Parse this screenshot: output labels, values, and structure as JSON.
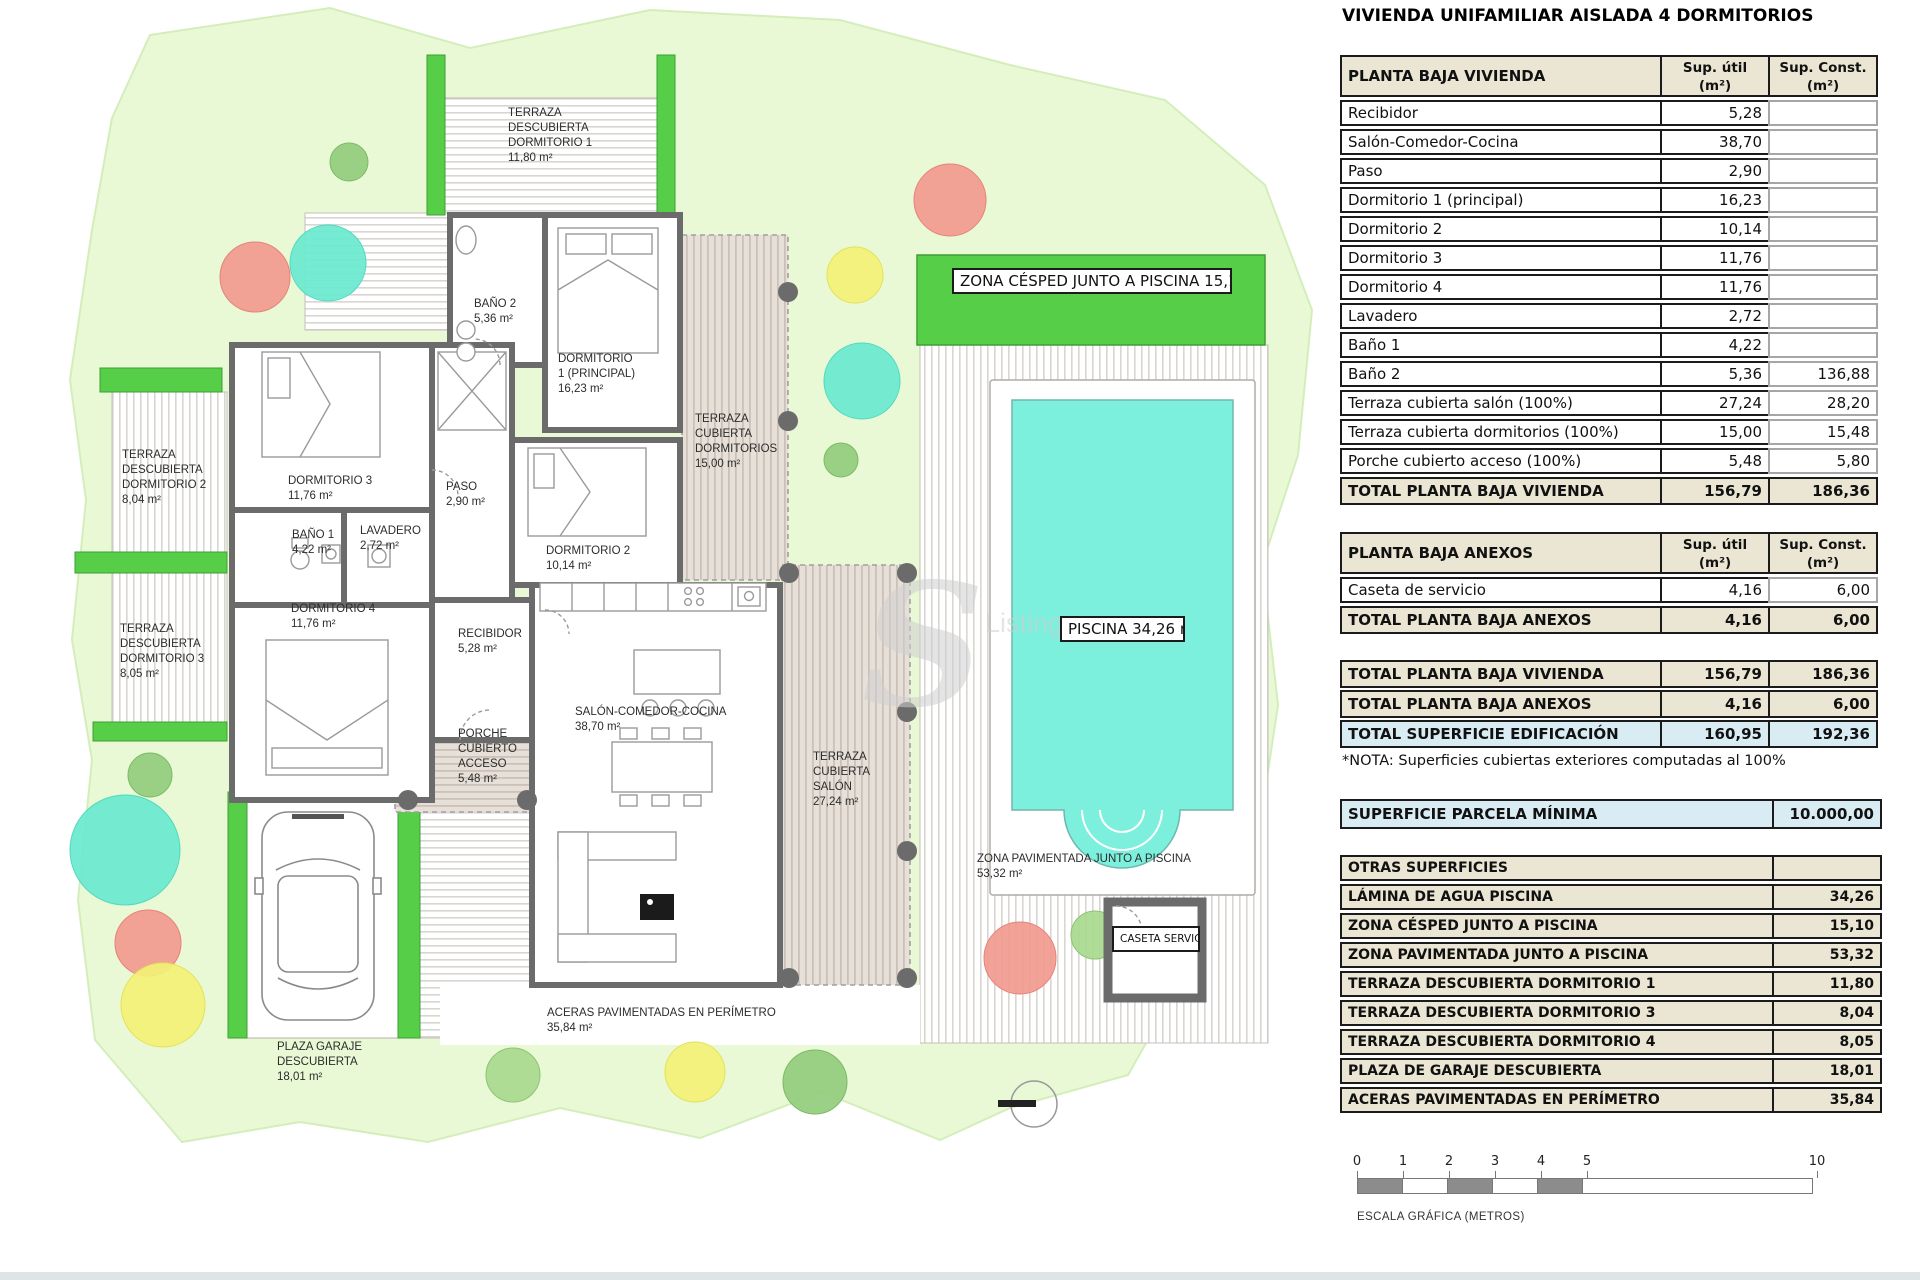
{
  "title": "VIVIENDA UNIFAMILIAR AISLADA 4 DORMITORIOS",
  "tables": {
    "vivienda": {
      "header": "PLANTA BAJA VIVIENDA",
      "col_util": "Sup. útil\n(m²)",
      "col_const": "Sup. Const.\n(m²)",
      "rows": [
        {
          "label": "Recibidor",
          "util": "5,28",
          "const": ""
        },
        {
          "label": "Salón-Comedor-Cocina",
          "util": "38,70",
          "const": ""
        },
        {
          "label": "Paso",
          "util": "2,90",
          "const": ""
        },
        {
          "label": "Dormitorio 1 (principal)",
          "util": "16,23",
          "const": ""
        },
        {
          "label": "Dormitorio 2",
          "util": "10,14",
          "const": ""
        },
        {
          "label": "Dormitorio 3",
          "util": "11,76",
          "const": ""
        },
        {
          "label": "Dormitorio 4",
          "util": "11,76",
          "const": ""
        },
        {
          "label": "Lavadero",
          "util": "2,72",
          "const": ""
        },
        {
          "label": "Baño 1",
          "util": "4,22",
          "const": ""
        },
        {
          "label": "Baño 2",
          "util": "5,36",
          "const": "136,88"
        },
        {
          "label": "Terraza cubierta salón (100%)",
          "util": "27,24",
          "const": "28,20"
        },
        {
          "label": "Terraza cubierta dormitorios (100%)",
          "util": "15,00",
          "const": "15,48"
        },
        {
          "label": "Porche cubierto acceso (100%)",
          "util": "5,48",
          "const": "5,80"
        }
      ],
      "total": {
        "label": "TOTAL PLANTA BAJA VIVIENDA",
        "util": "156,79",
        "const": "186,36"
      }
    },
    "anexos": {
      "header": "PLANTA BAJA ANEXOS",
      "col_util": "Sup. útil\n(m²)",
      "col_const": "Sup. Const.\n(m²)",
      "rows": [
        {
          "label": "Caseta de servicio",
          "util": "4,16",
          "const": "6,00"
        }
      ],
      "total": {
        "label": "TOTAL PLANTA BAJA ANEXOS",
        "util": "4,16",
        "const": "6,00"
      }
    },
    "resumen": {
      "rows": [
        {
          "label": "TOTAL PLANTA BAJA VIVIENDA",
          "util": "156,79",
          "const": "186,36"
        },
        {
          "label": "TOTAL PLANTA BAJA ANEXOS",
          "util": "4,16",
          "const": "6,00"
        },
        {
          "label": "TOTAL SUPERFICIE EDIFICACIÓN",
          "util": "160,95",
          "const": "192,36"
        }
      ],
      "nota": "*NOTA: Superficies cubiertas exteriores computadas al 100%"
    },
    "parcela": {
      "label": "SUPERFICIE PARCELA MÍNIMA",
      "value": "10.000,00"
    },
    "otras": {
      "header": "OTRAS SUPERFICIES",
      "rows": [
        {
          "label": "LÁMINA DE AGUA PISCINA",
          "value": "34,26"
        },
        {
          "label": "ZONA CÉSPED JUNTO A PISCINA",
          "value": "15,10"
        },
        {
          "label": "ZONA PAVIMENTADA JUNTO A PISCINA",
          "value": "53,32"
        },
        {
          "label": "TERRAZA DESCUBIERTA DORMITORIO 1",
          "value": "11,80"
        },
        {
          "label": "TERRAZA DESCUBIERTA DORMITORIO 3",
          "value": "8,04"
        },
        {
          "label": "TERRAZA DESCUBIERTA DORMITORIO 4",
          "value": "8,05"
        },
        {
          "label": "PLAZA DE GARAJE DESCUBIERTA",
          "value": "18,01"
        },
        {
          "label": "ACERAS PAVIMENTADAS EN PERÍMETRO",
          "value": "35,84"
        }
      ]
    }
  },
  "escala": {
    "ticks": [
      "0",
      "1",
      "2",
      "3",
      "4",
      "5",
      "10"
    ],
    "caption": "ESCALA GRÁFICA (METROS)"
  },
  "plan": {
    "watermark_s": "S",
    "watermark_text": "Listings",
    "labels": {
      "terraza_dorm1": "TERRAZA\nDESCUBIERTA\nDORMITORIO 1\n11,80 m²",
      "bano2": "BAÑO 2\n5,36 m²",
      "dorm1": "DORMITORIO\n1 (PRINCIPAL)\n16,23 m²",
      "terraza_cub_dorm": "TERRAZA\nCUBIERTA\nDORMITORIOS\n15,00 m²",
      "terraza_desc_d2": "TERRAZA\nDESCUBIERTA\nDORMITORIO 2\n8,04 m²",
      "dorm3": "DORMITORIO 3\n11,76 m²",
      "paso": "PASO\n2,90 m²",
      "bano1": "BAÑO 1\n4,22 m²",
      "lavadero": "LAVADERO\n2,72 m²",
      "dorm2": "DORMITORIO 2\n10,14 m²",
      "terraza_desc_d3": "TERRAZA\nDESCUBIERTA\nDORMITORIO 3\n8,05 m²",
      "dorm4": "DORMITORIO 4\n11,76 m²",
      "recibidor": "RECIBIDOR\n5,28 m²",
      "salon": "SALÓN-COMEDOR-COCINA\n38,70 m²",
      "porche": "PORCHE\nCUBIERTO\nACCESO\n5,48 m²",
      "terraza_cub_salon": "TERRAZA\nCUBIERTA\nSALÓN\n27,24 m²",
      "zona_cesped": "ZONA CÉSPED JUNTO A PISCINA\n15,10 m²",
      "piscina": "PISCINA\n34,26 m²",
      "zona_pav": "ZONA PAVIMENTADA JUNTO A PISCINA\n53,32 m²",
      "caseta": "CASETA\nSERVICIO\n4,16 m²",
      "aceras": "ACERAS PAVIMENTADAS EN PERÍMETRO\n35,84 m²",
      "plaza_garaje": "PLAZA GARAJE\nDESCUBIERTA\n18,01 m²"
    }
  },
  "colors": {
    "grass_bright": "#57ce47",
    "parcel": "#e9f9d5",
    "pool_water": "#7cefdd",
    "table_beige": "#eae6d3",
    "table_blue": "#d9ecf4"
  }
}
